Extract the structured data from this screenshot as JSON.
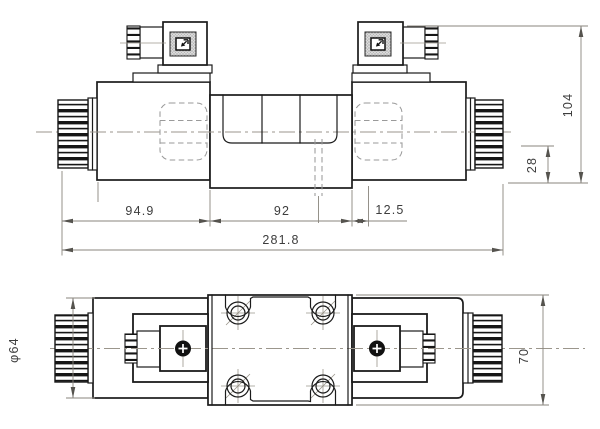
{
  "front_view": {
    "dims": {
      "solenoid_side_length": "94.9",
      "body_length": "92",
      "port_offset": "12.5",
      "overall_length": "281.8",
      "overall_height": "104",
      "base_to_bottom": "28"
    }
  },
  "plan_view": {
    "dims": {
      "coil_diameter": "φ64",
      "body_width": "70"
    }
  }
}
